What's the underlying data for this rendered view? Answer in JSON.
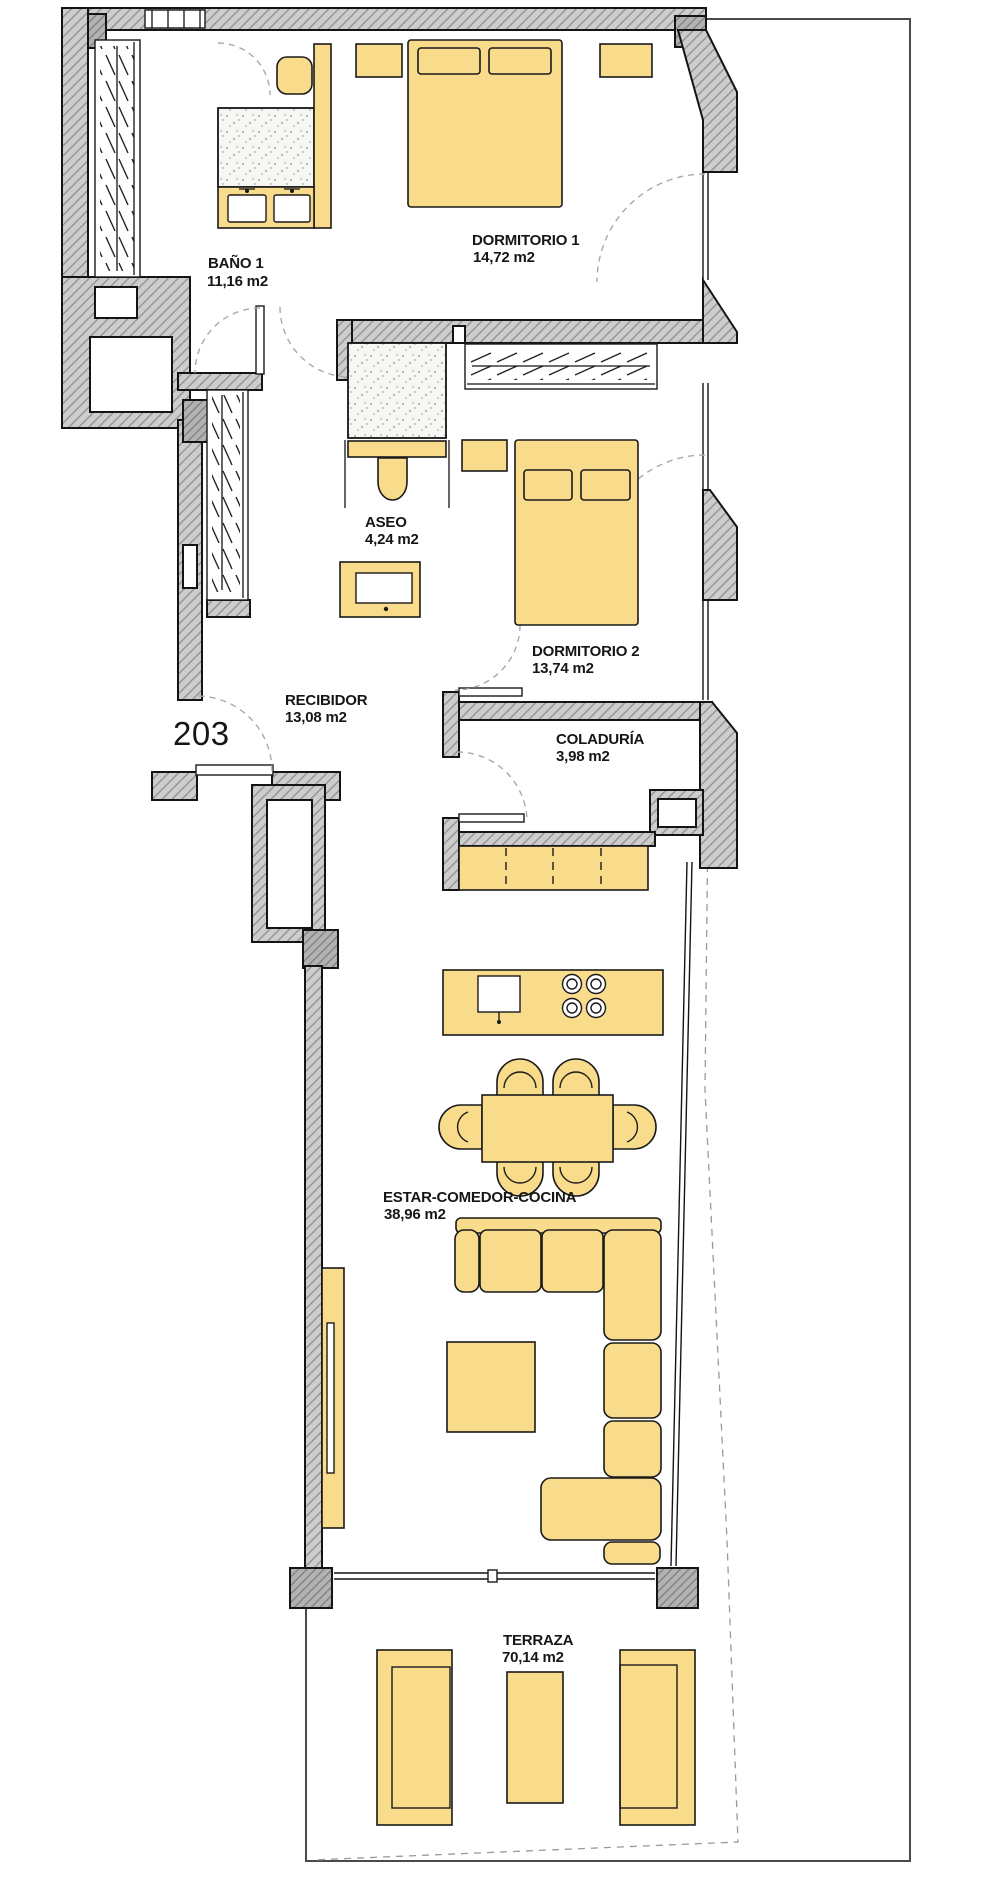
{
  "title": "Floor plan apartment 203",
  "unit_number": "203",
  "rooms": [
    {
      "id": "bano1",
      "name": "BAÑO 1",
      "area": "11,16 m2"
    },
    {
      "id": "dormitorio1",
      "name": "DORMITORIO 1",
      "area": "14,72 m2"
    },
    {
      "id": "aseo",
      "name": "ASEO",
      "area": "4,24 m2"
    },
    {
      "id": "dormitorio2",
      "name": "DORMITORIO 2",
      "area": "13,74 m2"
    },
    {
      "id": "recibidor",
      "name": "RECIBIDOR",
      "area": "13,08 m2"
    },
    {
      "id": "coladuria",
      "name": "COLADURÍA",
      "area": "3,98 m2"
    },
    {
      "id": "estar",
      "name": "ESTAR-COMEDOR-COCINA",
      "area": "38,96 m2"
    },
    {
      "id": "terraza",
      "name": "TERRAZA",
      "area": "70,14 m2"
    }
  ],
  "colors": {
    "furniture": "#f9dc8b",
    "wall_fill": "#cccccc",
    "wall_dark": "#b0b0b0",
    "line": "#1a1a1a",
    "boundary": "#4a4a4a"
  }
}
